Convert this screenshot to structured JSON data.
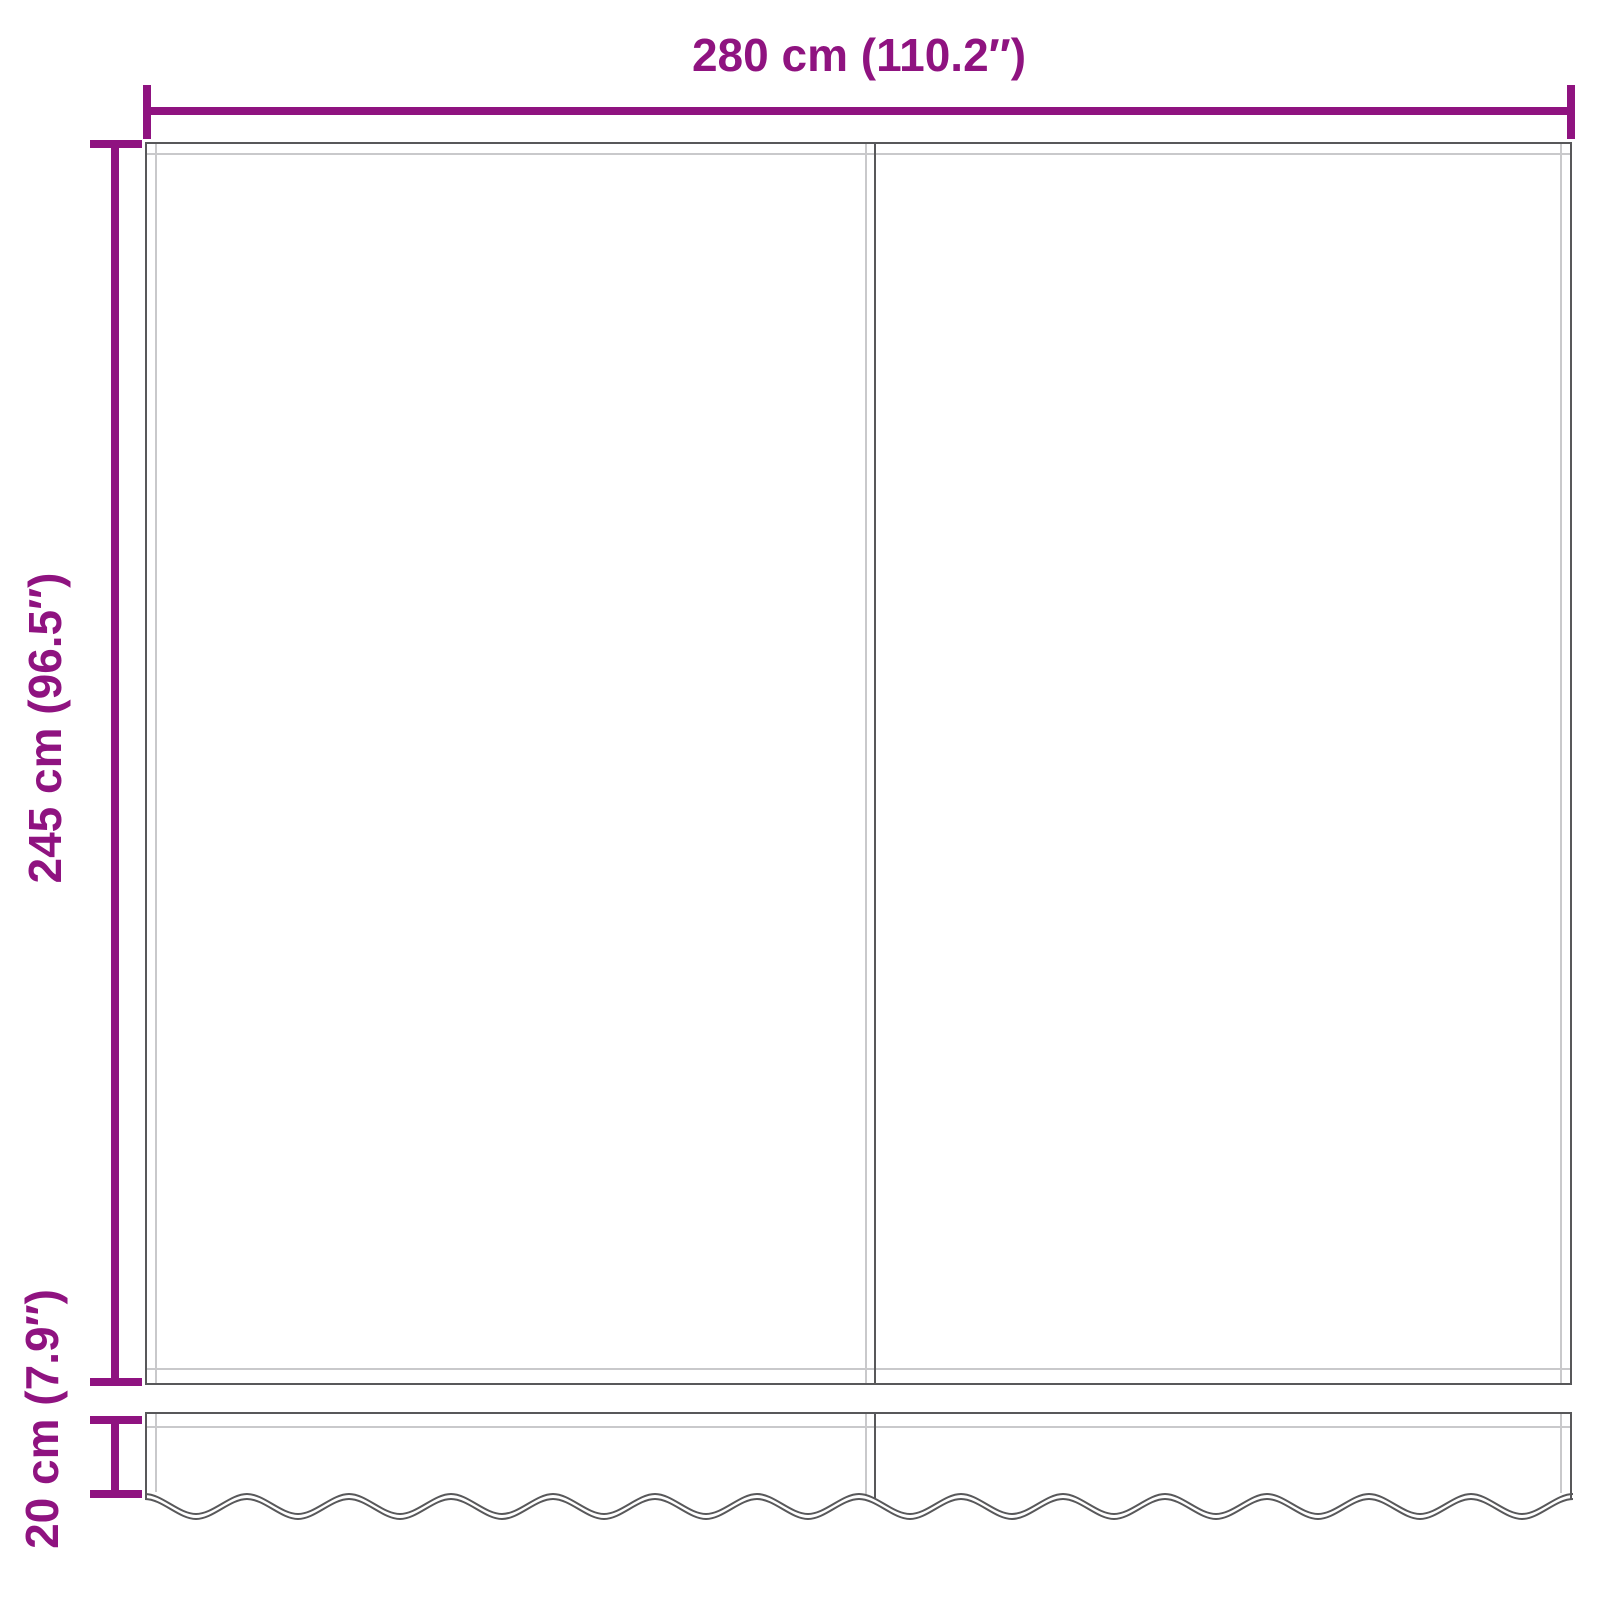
{
  "colors": {
    "dimension": "#8F1380",
    "outline": "#58585A",
    "hem": "#C9C9CB",
    "background": "#FFFFFF"
  },
  "dimensions": {
    "width": {
      "label": "280 cm (110.2″)"
    },
    "height": {
      "label": "245 cm (96.5″)"
    },
    "valance_height": {
      "label": "20 cm (7.9″)"
    }
  }
}
